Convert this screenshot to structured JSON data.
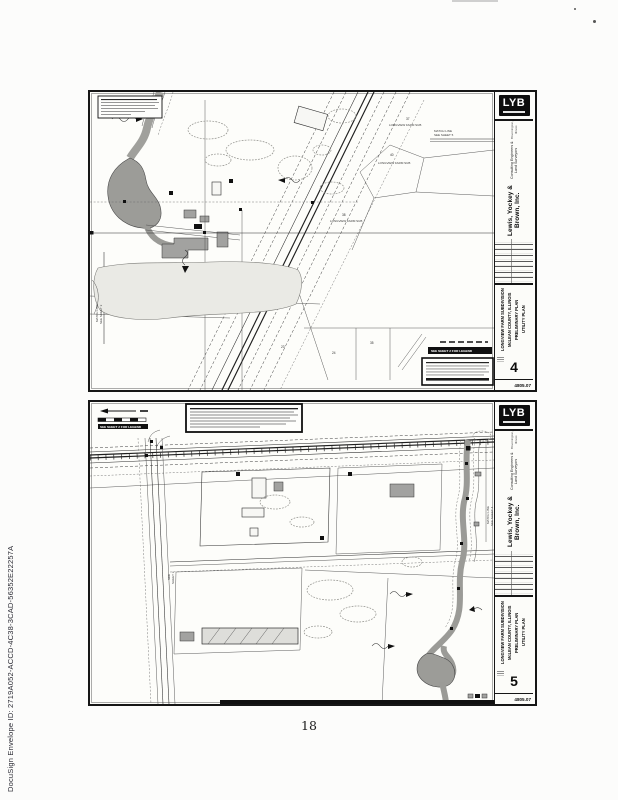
{
  "document": {
    "stamp": "DocuSign Envelope ID: 2719A052-ACCD-4C38-3CAD-56352E22257A",
    "page_number": "18"
  },
  "titleblock": {
    "logo": "LYB",
    "company": "Lewis, Yockey & Brown, Inc.",
    "tagline": "Consulting Engineers & Land Surveyors",
    "address": "Bloomington, Illinois"
  },
  "sheets": [
    {
      "number": "4",
      "job_number": "4805.07",
      "project_lines": [
        "LONGVIEW FARM SUBDIVISION",
        "McLEAN COUNTY, ILLINOIS",
        "PRELIMINARY PLAN",
        "UTILITY PLAN"
      ],
      "legend_note": "SEE SHEET 2 FOR LEGEND",
      "match_left": [
        "MATCH LINE",
        "SEE SHEET 3"
      ],
      "match_right": [
        "MATCH LINE",
        "SEE SHEET 5"
      ],
      "labels": {
        "sub1": "LONGVIEW FARM SUB",
        "sub2": "LONGVIEW FARM SUB",
        "sub3": "LONGVIEW FARM SUB",
        "lot37": "37",
        "lot40": "40",
        "lot38": "38",
        "lot23": "23",
        "lot24": "24",
        "lot35": "35"
      }
    },
    {
      "number": "5",
      "job_number": "4805.07",
      "project_lines": [
        "LONGVIEW FARM SUBDIVISION",
        "McLEAN COUNTY, ILLINOIS",
        "PRELIMINARY PLAN",
        "UTILITY PLAN"
      ],
      "legend_note": "SEE SHEET 2 FOR LEGEND",
      "match_right": [
        "MATCH LINE",
        "SEE SHEET 4"
      ],
      "road_note": [
        "SEE",
        "SHEET 3"
      ]
    }
  ]
}
